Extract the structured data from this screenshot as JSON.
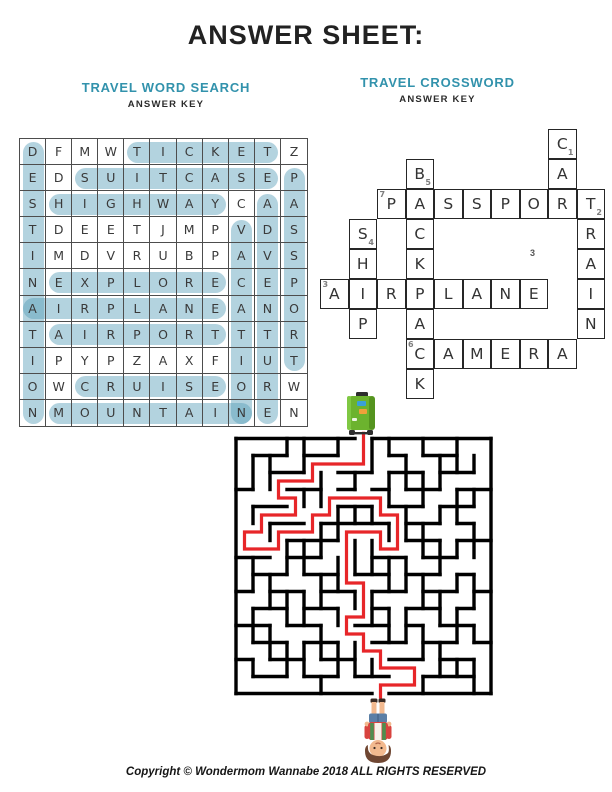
{
  "page": {
    "title": "ANSWER SHEET:",
    "copyright": "Copyright © Wondermom Wannabe 2018 ALL RIGHTS RESERVED"
  },
  "colors": {
    "teal_heading": "#3292ac",
    "highlight": "rgba(86,158,185,0.45)",
    "maze_wall": "#000000",
    "solution_red": "#e72629",
    "suitcase_green": "#6cb32e"
  },
  "word_search": {
    "title": "TRAVEL WORD SEARCH",
    "subtitle": "ANSWER KEY",
    "grid": [
      "DFMWTICKETZ",
      "EDSUITCASEP",
      "SHIGHWAYCAA",
      "TDEETJMPVDS",
      "IMDVRUBPAVS",
      "NEXPLORECEP",
      "AIRPLANEANO",
      "TAIRPORTTTR",
      "IPYPZAXFIUT",
      "OWCRUISEORW",
      "NMOUNTAINEN"
    ],
    "highlights_horizontal": [
      {
        "word": "TICKET",
        "row": 1,
        "col_start": 5,
        "col_end": 10
      },
      {
        "word": "SUITCASE",
        "row": 2,
        "col_start": 3,
        "col_end": 10
      },
      {
        "word": "HIGHWAY",
        "row": 3,
        "col_start": 2,
        "col_end": 8
      },
      {
        "word": "EXPLORE",
        "row": 6,
        "col_start": 2,
        "col_end": 8
      },
      {
        "word": "AIRPLANE",
        "row": 7,
        "col_start": 1,
        "col_end": 8
      },
      {
        "word": "AIRPORT",
        "row": 8,
        "col_start": 2,
        "col_end": 8
      },
      {
        "word": "CRUISE",
        "row": 10,
        "col_start": 3,
        "col_end": 8
      },
      {
        "word": "MOUNTAIN",
        "row": 11,
        "col_start": 2,
        "col_end": 9
      }
    ],
    "highlights_vertical": [
      {
        "word": "DESTINATION",
        "col": 1,
        "row_start": 1,
        "row_end": 11
      },
      {
        "word": "VACATION",
        "col": 9,
        "row_start": 4,
        "row_end": 11
      },
      {
        "word": "ADVENTURE",
        "col": 10,
        "row_start": 3,
        "row_end": 11
      },
      {
        "word": "PASSPORT",
        "col": 11,
        "row_start": 2,
        "row_end": 9
      }
    ]
  },
  "crossword": {
    "title": "TRAVEL CROSSWORD",
    "subtitle": "ANSWER KEY",
    "answers": [
      {
        "num": "1",
        "word": "CAR",
        "dir": "down"
      },
      {
        "num": "2",
        "word": "TRAIN",
        "dir": "down"
      },
      {
        "num": "3",
        "word": "AIRPLANE",
        "dir": "across"
      },
      {
        "num": "4",
        "word": "SHIP",
        "dir": "down"
      },
      {
        "num": "5",
        "word": "BACKPACK",
        "dir": "down"
      },
      {
        "num": "6",
        "word": "CAMERA",
        "dir": "across"
      },
      {
        "num": "7",
        "word": "PASSPORT",
        "dir": "across"
      }
    ],
    "stray_number": "3",
    "cells": [
      {
        "col": 9,
        "row": 1,
        "letter": "C",
        "num": "1",
        "num_pos": "br"
      },
      {
        "col": 4,
        "row": 2,
        "letter": "B",
        "num": "5",
        "num_pos": "br"
      },
      {
        "col": 9,
        "row": 2,
        "letter": "A"
      },
      {
        "col": 3,
        "row": 3,
        "letter": "P",
        "num": "7",
        "num_pos": "tl"
      },
      {
        "col": 4,
        "row": 3,
        "letter": "A"
      },
      {
        "col": 5,
        "row": 3,
        "letter": "S"
      },
      {
        "col": 6,
        "row": 3,
        "letter": "S"
      },
      {
        "col": 7,
        "row": 3,
        "letter": "P"
      },
      {
        "col": 8,
        "row": 3,
        "letter": "O"
      },
      {
        "col": 9,
        "row": 3,
        "letter": "R"
      },
      {
        "col": 10,
        "row": 3,
        "letter": "T",
        "num": "2",
        "num_pos": "br"
      },
      {
        "col": 2,
        "row": 4,
        "letter": "S",
        "num": "4",
        "num_pos": "br"
      },
      {
        "col": 4,
        "row": 4,
        "letter": "C"
      },
      {
        "col": 10,
        "row": 4,
        "letter": "R"
      },
      {
        "col": 2,
        "row": 5,
        "letter": "H"
      },
      {
        "col": 4,
        "row": 5,
        "letter": "K"
      },
      {
        "col": 10,
        "row": 5,
        "letter": "A"
      },
      {
        "col": 1,
        "row": 6,
        "letter": "A",
        "num": "3",
        "num_pos": "tl"
      },
      {
        "col": 2,
        "row": 6,
        "letter": "I"
      },
      {
        "col": 3,
        "row": 6,
        "letter": "R"
      },
      {
        "col": 4,
        "row": 6,
        "letter": "P"
      },
      {
        "col": 5,
        "row": 6,
        "letter": "L"
      },
      {
        "col": 6,
        "row": 6,
        "letter": "A"
      },
      {
        "col": 7,
        "row": 6,
        "letter": "N"
      },
      {
        "col": 8,
        "row": 6,
        "letter": "E"
      },
      {
        "col": 10,
        "row": 6,
        "letter": "I"
      },
      {
        "col": 2,
        "row": 7,
        "letter": "P"
      },
      {
        "col": 4,
        "row": 7,
        "letter": "A"
      },
      {
        "col": 10,
        "row": 7,
        "letter": "N"
      },
      {
        "col": 4,
        "row": 8,
        "letter": "C",
        "num": "6",
        "num_pos": "tl"
      },
      {
        "col": 5,
        "row": 8,
        "letter": "A"
      },
      {
        "col": 6,
        "row": 8,
        "letter": "M"
      },
      {
        "col": 7,
        "row": 8,
        "letter": "E"
      },
      {
        "col": 8,
        "row": 8,
        "letter": "R"
      },
      {
        "col": 9,
        "row": 8,
        "letter": "A"
      },
      {
        "col": 4,
        "row": 9,
        "letter": "K"
      }
    ]
  },
  "maze": {
    "cols": 15,
    "rows": 15,
    "cell": 17,
    "entrance_top_col": 7,
    "exit_bottom_col": 8,
    "h_walls": {
      "1": [
        [
          1,
          3
        ],
        [
          4,
          6
        ],
        [
          9,
          10
        ],
        [
          11,
          13
        ]
      ],
      "2": [
        [
          2,
          4
        ],
        [
          6,
          8
        ],
        [
          9,
          11
        ],
        [
          12,
          14
        ]
      ],
      "3": [
        [
          0,
          1
        ],
        [
          3,
          5
        ],
        [
          6,
          7
        ],
        [
          8,
          9
        ],
        [
          10,
          12
        ],
        [
          13,
          15
        ]
      ],
      "4": [
        [
          1,
          3
        ],
        [
          6,
          8
        ],
        [
          9,
          11
        ],
        [
          12,
          14
        ]
      ],
      "5": [
        [
          2,
          4
        ],
        [
          5,
          9
        ],
        [
          10,
          12
        ],
        [
          13,
          14
        ]
      ],
      "6": [
        [
          3,
          6
        ],
        [
          10,
          12
        ],
        [
          13,
          15
        ]
      ],
      "7": [
        [
          0,
          2
        ],
        [
          3,
          5
        ],
        [
          8,
          10
        ],
        [
          11,
          13
        ]
      ],
      "8": [
        [
          1,
          3
        ],
        [
          4,
          6
        ],
        [
          7,
          9
        ],
        [
          10,
          12
        ],
        [
          13,
          14
        ]
      ],
      "9": [
        [
          0,
          1
        ],
        [
          2,
          4
        ],
        [
          5,
          7
        ],
        [
          8,
          10
        ],
        [
          11,
          13
        ],
        [
          14,
          15
        ]
      ],
      "10": [
        [
          1,
          3
        ],
        [
          4,
          6
        ],
        [
          8,
          9
        ],
        [
          10,
          12
        ],
        [
          13,
          14
        ]
      ],
      "11": [
        [
          0,
          2
        ],
        [
          3,
          5
        ],
        [
          7,
          9
        ],
        [
          10,
          11
        ],
        [
          12,
          14
        ]
      ],
      "12": [
        [
          1,
          3
        ],
        [
          4,
          6
        ],
        [
          8,
          10
        ],
        [
          11,
          13
        ],
        [
          14,
          15
        ]
      ],
      "13": [
        [
          0,
          1
        ],
        [
          2,
          4
        ],
        [
          5,
          7
        ],
        [
          9,
          11
        ],
        [
          12,
          14
        ]
      ],
      "14": [
        [
          1,
          3
        ],
        [
          4,
          6
        ],
        [
          7,
          9
        ],
        [
          11,
          14
        ]
      ]
    },
    "v_walls": {
      "1": [
        [
          1,
          3
        ],
        [
          4,
          5
        ],
        [
          7,
          9
        ],
        [
          10,
          12
        ],
        [
          13,
          14
        ]
      ],
      "2": [
        [
          1,
          3
        ],
        [
          5,
          6
        ],
        [
          8,
          10
        ],
        [
          11,
          13
        ]
      ],
      "3": [
        [
          0,
          1
        ],
        [
          6,
          8
        ],
        [
          9,
          11
        ],
        [
          12,
          14
        ]
      ],
      "4": [
        [
          0,
          2
        ],
        [
          3,
          4
        ],
        [
          6,
          8
        ],
        [
          9,
          11
        ],
        [
          12,
          14
        ]
      ],
      "5": [
        [
          2,
          4
        ],
        [
          5,
          7
        ],
        [
          8,
          10
        ],
        [
          11,
          13
        ],
        [
          14,
          15
        ]
      ],
      "6": [
        [
          0,
          1
        ],
        [
          4,
          6
        ],
        [
          7,
          9
        ],
        [
          10,
          11
        ],
        [
          12,
          14
        ]
      ],
      "7": [
        [
          2,
          3
        ],
        [
          4,
          5
        ],
        [
          6,
          8
        ],
        [
          9,
          10
        ],
        [
          12,
          14
        ]
      ],
      "8": [
        [
          0,
          2
        ],
        [
          4,
          5
        ],
        [
          6,
          8
        ],
        [
          9,
          11
        ],
        [
          13,
          14
        ]
      ],
      "9": [
        [
          0,
          1
        ],
        [
          2,
          4
        ],
        [
          5,
          6
        ],
        [
          7,
          9
        ],
        [
          10,
          12
        ]
      ],
      "10": [
        [
          1,
          3
        ],
        [
          4,
          6
        ],
        [
          7,
          9
        ],
        [
          10,
          12
        ]
      ],
      "11": [
        [
          0,
          1
        ],
        [
          2,
          4
        ],
        [
          5,
          7
        ],
        [
          8,
          10
        ],
        [
          11,
          13
        ],
        [
          14,
          15
        ]
      ],
      "12": [
        [
          1,
          3
        ],
        [
          4,
          5
        ],
        [
          6,
          8
        ],
        [
          9,
          11
        ],
        [
          12,
          14
        ]
      ],
      "13": [
        [
          0,
          2
        ],
        [
          3,
          5
        ],
        [
          6,
          7
        ],
        [
          8,
          9
        ],
        [
          10,
          12
        ],
        [
          13,
          14
        ]
      ],
      "14": [
        [
          1,
          2
        ],
        [
          3,
          4
        ],
        [
          5,
          7
        ],
        [
          8,
          10
        ],
        [
          11,
          12
        ],
        [
          13,
          15
        ]
      ]
    },
    "solution_points": [
      [
        7.5,
        -0.4
      ],
      [
        7.5,
        1.5
      ],
      [
        4.5,
        1.5
      ],
      [
        4.5,
        2.5
      ],
      [
        2.5,
        2.5
      ],
      [
        2.5,
        3.5
      ],
      [
        3.5,
        3.5
      ],
      [
        3.5,
        4.5
      ],
      [
        1.5,
        4.5
      ],
      [
        1.5,
        5.5
      ],
      [
        0.5,
        5.5
      ],
      [
        0.5,
        6.5
      ],
      [
        2.5,
        6.5
      ],
      [
        2.5,
        5.5
      ],
      [
        4.5,
        5.5
      ],
      [
        4.5,
        4.5
      ],
      [
        5.5,
        4.5
      ],
      [
        5.5,
        3.5
      ],
      [
        8.5,
        3.5
      ],
      [
        8.5,
        4.5
      ],
      [
        9.5,
        4.5
      ],
      [
        9.5,
        6.5
      ],
      [
        8.5,
        6.5
      ],
      [
        8.5,
        5.5
      ],
      [
        6.5,
        5.5
      ],
      [
        6.5,
        8.5
      ],
      [
        7.5,
        8.5
      ],
      [
        7.5,
        10.5
      ],
      [
        6.5,
        10.5
      ],
      [
        6.5,
        11.5
      ],
      [
        7.5,
        11.5
      ],
      [
        7.5,
        12.5
      ],
      [
        8.5,
        12.5
      ],
      [
        8.5,
        13.5
      ],
      [
        10.5,
        13.5
      ],
      [
        10.5,
        14.5
      ],
      [
        8.5,
        14.5
      ],
      [
        8.5,
        15.3
      ]
    ]
  },
  "icons": {
    "maze_start": "suitcase-icon",
    "maze_end": "traveler-upside-down-icon"
  }
}
